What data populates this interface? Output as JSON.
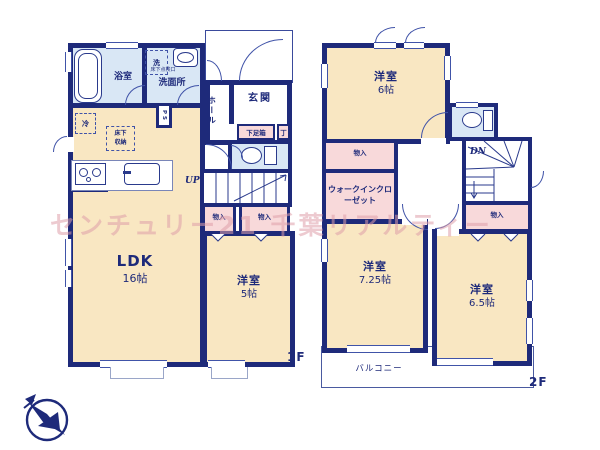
{
  "watermark": "センチュリー21 千葉リアルティー",
  "colors": {
    "wall_navy": "#1e2a7a",
    "room_cream": "#f9e7c2",
    "wet_area_blue": "#d9e7f5",
    "closet_pink": "#f8d9da",
    "watermark_pink": "#e0a5af"
  },
  "floor1": {
    "floor_label": "1F",
    "bath": {
      "label": "浴室"
    },
    "washroom": {
      "label": "洗面所",
      "washer": "洗",
      "hatch": "床下点検口"
    },
    "entrance": {
      "label": "玄関",
      "shoe_box": "下足箱",
      "shoe_box_t": "丁"
    },
    "hall": {
      "label": "ホール"
    },
    "stairs": {
      "label": "UP"
    },
    "ps": {
      "label": "PS"
    },
    "fridge": {
      "label": "冷"
    },
    "floor_storage": {
      "label": "床下収納"
    },
    "closet_a": {
      "label": "物入"
    },
    "closet_b": {
      "label": "物入"
    },
    "ldk": {
      "name": "LDK",
      "size": "16帖"
    },
    "bedroom": {
      "name": "洋室",
      "size": "5帖"
    }
  },
  "floor2": {
    "floor_label": "2F",
    "bedroom6": {
      "name": "洋室",
      "size": "6帖"
    },
    "closet_a": {
      "label": "物入"
    },
    "wic": {
      "label": "ウォークインクローゼット"
    },
    "stairs": {
      "label": "DN"
    },
    "bedroom725": {
      "name": "洋室",
      "size": "7.25帖"
    },
    "closet_b": {
      "label": "物入"
    },
    "bedroom65": {
      "name": "洋室",
      "size": "6.5帖"
    },
    "balcony": {
      "label": "バルコニー"
    }
  }
}
